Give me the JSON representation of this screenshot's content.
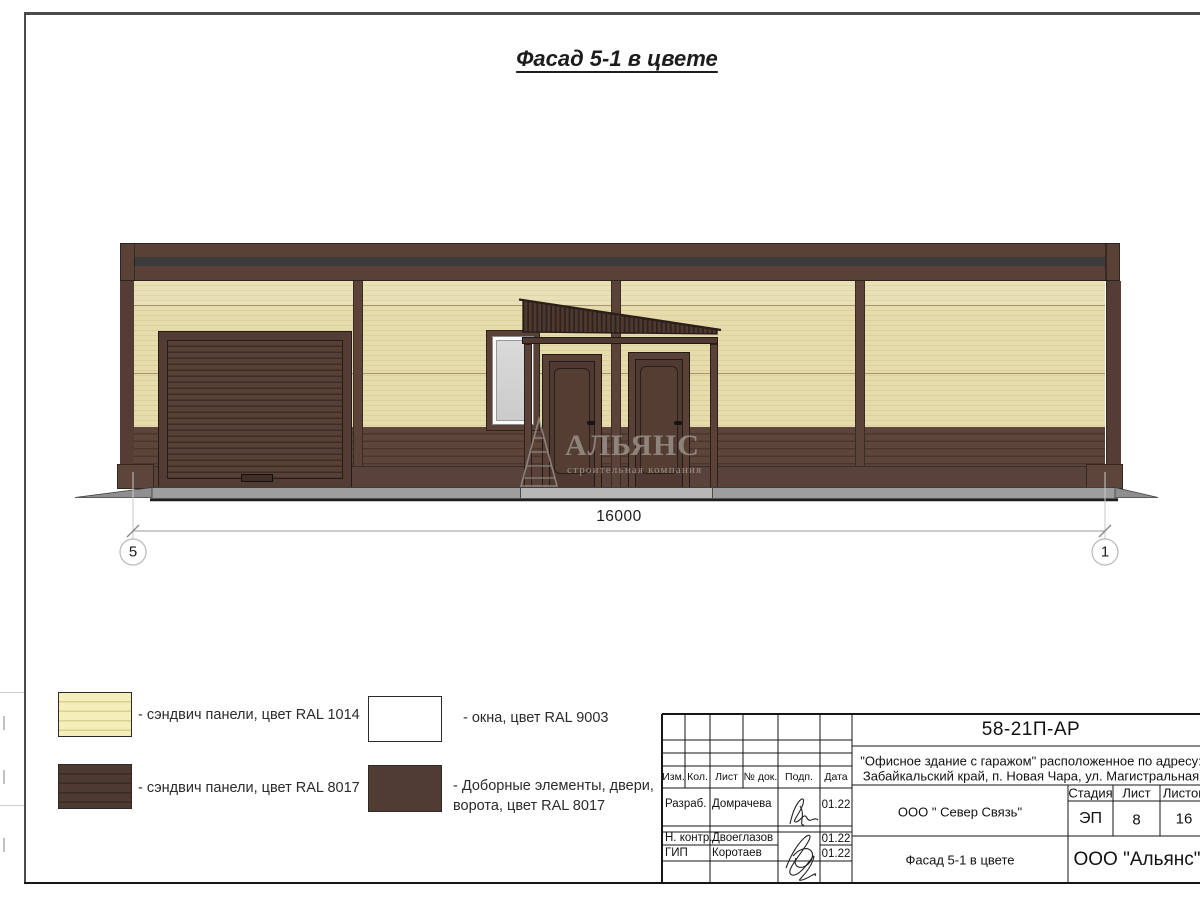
{
  "sheet": {
    "title": "Фасад 5-1 в цвете"
  },
  "drawing": {
    "dimension_label": "16000",
    "axis_markers": {
      "left": "5",
      "right": "1"
    },
    "watermark": {
      "name": "АЛЬЯНС",
      "tagline": "строительная компания"
    }
  },
  "legend": {
    "items": [
      {
        "id": "sandwich-cream",
        "label": "- сэндвич панели, цвет RAL 1014",
        "color": "#E6DCAB"
      },
      {
        "id": "sandwich-brown",
        "label": "- сэндвич панели, цвет RAL 8017",
        "color": "#4E3A31"
      },
      {
        "id": "windows",
        "label": "- окна, цвет RAL 9003",
        "color": "#FFFFFF"
      },
      {
        "id": "doors-extras",
        "label": "- Доборные элементы, двери, ворота, цвет RAL 8017",
        "color": "#513C33"
      }
    ]
  },
  "titleblock": {
    "doc_number": "58-21П-АР",
    "project_line1": "\"Офисное здание с гаражом\" расположенное по адресу:",
    "project_line2": "Забайкальский край, п. Новая Чара, ул. Магистральная",
    "columns": {
      "izm": "Изм.",
      "kol": "Кол.",
      "list": "Лист",
      "doc": "№ док.",
      "podp": "Подп.",
      "data": "Дата"
    },
    "signers": [
      {
        "role": "Разраб.",
        "name": "Домрачева",
        "date": "01.22"
      },
      {
        "role": "Н. контр.",
        "name": "Двоеглазов",
        "date": "01.22"
      },
      {
        "role": "ГИП",
        "name": "Коротаев",
        "date": "01.22"
      }
    ],
    "customer": "ООО \" Север Связь\"",
    "sheet_name": "Фасад 5-1 в цвете",
    "stage": {
      "label": "Стадия",
      "value": "ЭП"
    },
    "sheet_no": {
      "label": "Лист",
      "value": "8"
    },
    "sheets_total": {
      "label": "Листов",
      "value": "16"
    },
    "company": "ООО \"Альянс\""
  },
  "colors": {
    "ral1014_cream": "#E6DCAB",
    "ral8017_brown": "#4E3A31",
    "ral9003_white": "#FFFFFF",
    "cornice_stripe": "#3B3B3B",
    "window_glass": "#D3D3D3",
    "concrete": "#9E9E9E"
  }
}
